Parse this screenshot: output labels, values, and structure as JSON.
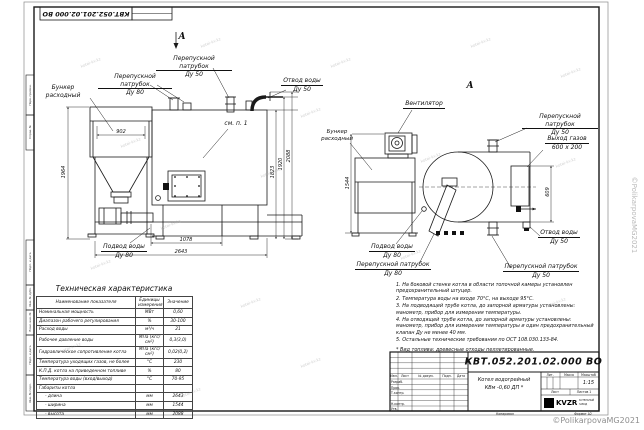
{
  "frame": {
    "corner_doc_number": "КВТ.052.201.02.000 ВО",
    "copied_label": "Копировал",
    "format_label": "Формат А2",
    "margin_stamps": [
      "Перв. примен.",
      "Справ. №",
      "Подп. и дата",
      "Инв. № дубл.",
      "Взам. инв. №",
      "Подп. и дата",
      "Инв. № подл."
    ]
  },
  "watermark": {
    "site": "kotel-kv.kz",
    "copyright": "©PolikarpovaMG2021"
  },
  "views": {
    "front": {
      "view_arrow_letter": "А",
      "labels": {
        "bunker": [
          "Бункер",
          "расходный"
        ],
        "bypass80": [
          "Перепускной патрубок",
          "Ду 80"
        ],
        "bypass50": [
          "Перепускной патрубок",
          "Ду 50"
        ],
        "water_out": [
          "Отвод воды",
          "Ду 50"
        ],
        "see_note": "см. п. 1",
        "water_in": [
          "Подвод воды",
          "Ду 80"
        ]
      },
      "dims": {
        "bunker_width": "902",
        "bunker_height": "1964",
        "h1": "1823",
        "h2": "1920",
        "h3": "2088",
        "base": "1078",
        "length": "2643"
      }
    },
    "side": {
      "view_letter": "А",
      "labels": {
        "fan": "Вентилятор",
        "bunker": [
          "Бункер",
          "расходный"
        ],
        "bypass50_top": [
          "Перепускной патрубок",
          "Ду 50"
        ],
        "gas_out": [
          "Выход газов",
          "600 х 200"
        ],
        "water_out": [
          "Отвод воды",
          "Ду 50"
        ],
        "bypass50_bottom": [
          "Перепускной патрубок",
          "Ду 50"
        ],
        "water_in": [
          "Подвод воды",
          "Ду 80"
        ],
        "bypass80": [
          "Перепускной патрубок",
          "Ду 80"
        ]
      },
      "dims": {
        "bunker_height": "1544",
        "gas_out_height": "609"
      }
    }
  },
  "spec_table": {
    "title": "Техническая характеристика",
    "headers": [
      "Наименование показателя",
      "Единицы измерения",
      "Значение"
    ],
    "rows": [
      [
        "Номинальная мощность",
        "МВт",
        "0,60"
      ],
      [
        "Диапазон рабочего регулирования",
        "%",
        "30-100"
      ],
      [
        "Расход воды",
        "м³/ч",
        "21"
      ],
      [
        "Рабочее давление воды",
        "МПа (кгс/см²)",
        "0,3(3,0)"
      ],
      [
        "Гидравлическое сопротивление котла",
        "МПа (кгс/см²)",
        "0,02(0,2)"
      ],
      [
        "Температура уходящих газов, не более",
        "°С",
        "230"
      ],
      [
        "К.П.Д. котла на приведенном топливе",
        "%",
        "80"
      ],
      [
        "Температура воды (вход/выход)",
        "°С",
        "70-95"
      ],
      [
        "Габариты котла",
        "",
        ""
      ],
      [
        "- длина",
        "мм",
        "2643"
      ],
      [
        "- ширина",
        "мм",
        "1544"
      ],
      [
        "- высота",
        "мм",
        "2088"
      ]
    ]
  },
  "notes": [
    "1. На боковой стенке котла в области топочной камеры установлен предохранительный штуцер.",
    "2. Температура воды на входе 70°С, на выходе 95°С.",
    "3. На подводящей трубе котла, до запорной арматуры установлены: манометр, прибор для измерения температуры.",
    "4. На отводящей трубе котла, до запорной арматуры установлены: манометр, прибор для измерения температуры и один предохранительный клапан Ду не менее 40 мм.",
    "5. Остальные технические требования по ОСТ 108.030.133-84.",
    "* Вид топлива: древесные отходы пеллетированные."
  ],
  "title_block": {
    "doc_number": "КВТ.052.201.02.000 ВО",
    "product_line1": "Котел водогрейный",
    "product_line2": "КВм -0,60  ДП *",
    "scale_value": "1:15",
    "lit_header": "Лит.",
    "mass_header": "Масса",
    "scale_header": "Масштаб",
    "sheet_label": "Лист",
    "sheets_label": "Листов 1",
    "rev_headers": [
      "Изм.",
      "Лист",
      "№ докум.",
      "Подп.",
      "Дата"
    ],
    "sign_rows": [
      "Разраб.",
      "Пров.",
      "Т.контр.",
      "Н.контр.",
      "Утв."
    ],
    "logo_text": "KVZR",
    "logo_sub1": "КОТЕЛЬНЫЙ",
    "logo_sub2": "ЗАВОД"
  }
}
